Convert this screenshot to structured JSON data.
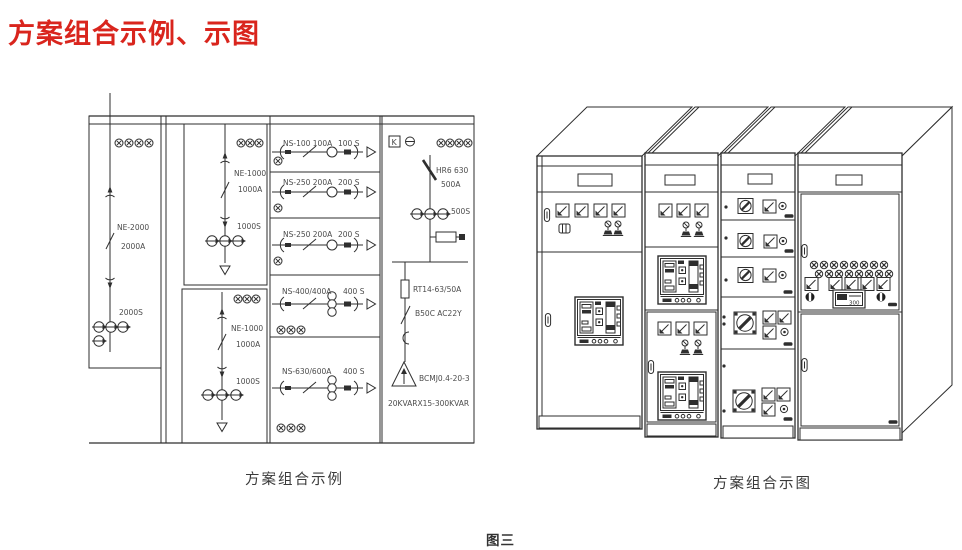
{
  "title": "方案组合示例、示图",
  "captions": {
    "left": "方案组合示例",
    "right": "方案组合示图",
    "figure": "图三"
  },
  "schematic": {
    "incoming": {
      "model": "NE-2000",
      "current": "2000A",
      "ct": "2000S"
    },
    "section2_top": {
      "model": "NE-1000",
      "current": "1000A",
      "ct": "1000S"
    },
    "section2_bottom": {
      "model": "NE-1000",
      "current": "1000A",
      "ct": "1000S"
    },
    "feeders": [
      {
        "device": "NS-100  100A",
        "switch": "100 S"
      },
      {
        "device": "NS-250  200A",
        "switch": "200 S"
      },
      {
        "device": "NS-250  200A",
        "switch": "200 S"
      },
      {
        "device": "NS-400/400A",
        "switch": "400 S"
      },
      {
        "device": "NS-630/600A",
        "switch": "400 S"
      }
    ],
    "capacitor_branch": {
      "k_label": "K",
      "switch": "HR6 630",
      "current": "500A",
      "ct": "500S",
      "fuse": "RT14-63/50A",
      "contactor": "B50C  AC22Y",
      "capacitor": "BCMJ0.4-20-3",
      "bank": "20KVARX15-300KVAR"
    }
  },
  "cabinets": {
    "meter_display": "300"
  },
  "colors": {
    "title": "#d9251d",
    "line": "#2e2e2e",
    "label": "#4c4c4c"
  }
}
